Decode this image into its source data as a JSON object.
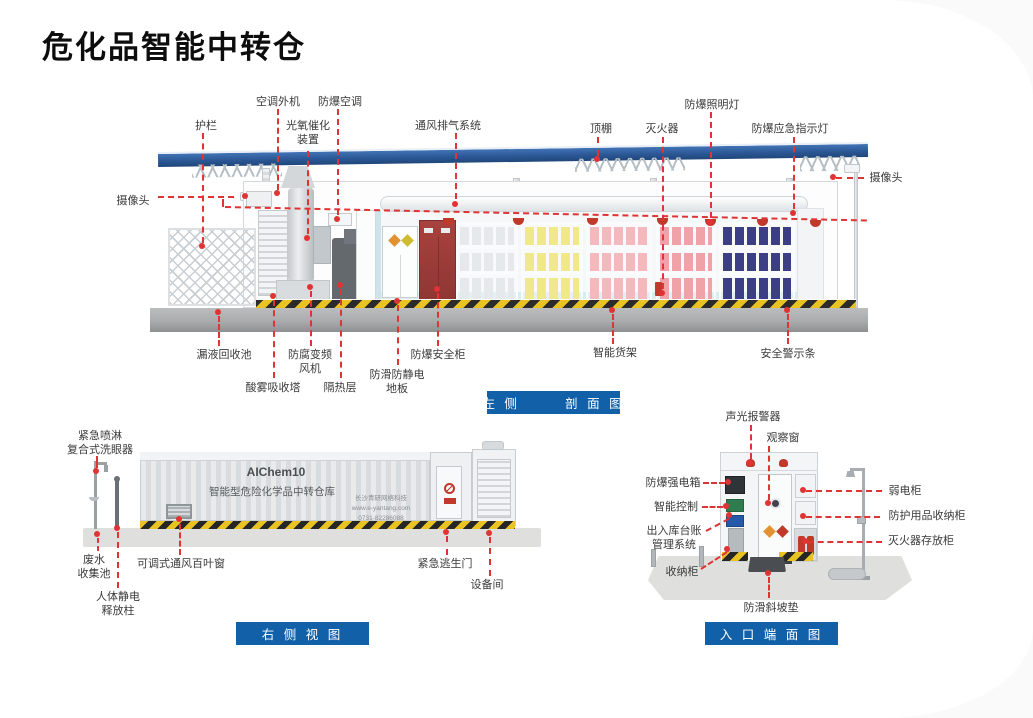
{
  "page": {
    "title": "危化品智能中转仓"
  },
  "colors": {
    "accent_blue": "#1160a8",
    "leader_red": "#e03333",
    "roof_blue": "#2d5f9e",
    "hazard_yellow": "#e9c322"
  },
  "cross_section": {
    "caption": "左 侧       剖 面 图",
    "labels": {
      "guardrail": "护栏",
      "camera_left": "摄像头",
      "ac_outdoor": "空调外机",
      "explosion_proof_ac": "防爆空调",
      "photocatalytic_device": "光氧催化\n装置",
      "ventilation_system": "通风排气系统",
      "canopy": "顶棚",
      "fire_extinguisher": "灭火器",
      "explosion_proof_lamp": "防爆照明灯",
      "emergency_indicator": "防爆应急指示灯",
      "camera_right": "摄像头",
      "leak_recovery_pool": "漏液回收池",
      "acid_mist_tower": "酸雾吸收塔",
      "anticorrosion_fan": "防腐变频\n风机",
      "insulation_layer": "隔热层",
      "antistatic_floor": "防滑防静电\n地板",
      "safety_cabinet": "防爆安全柜",
      "smart_shelf": "智能货架",
      "warning_strip": "安全警示条"
    }
  },
  "side_view": {
    "caption": "右 侧 视 图",
    "labels": {
      "eyewash": "紧急喷淋\n复合式洗眼器",
      "waste_pool": "废水\n收集池",
      "adjustable_louver": "可调式通风百叶窗",
      "static_release": "人体静电\n释放柱",
      "escape_door": "紧急逃生门",
      "equipment_room": "设备间"
    },
    "container": {
      "model": "AIChem10",
      "name": "智能型危险化学品中转仓库",
      "company": "长沙青研网络科技",
      "website": "www.e-yantang.com",
      "phone": "0731-82286088"
    }
  },
  "end_view": {
    "caption": "入 口 端 面 图",
    "labels": {
      "sound_light_alarm": "声光报警器",
      "observation_window": "观察窗",
      "strong_power_box": "防爆强电箱",
      "smart_control": "智能控制",
      "ledger_system": "出入库台账\n管理系统",
      "storage_cabinet": "收纳柜",
      "weak_power_cabinet": "弱电柜",
      "ppe_cabinet": "防护用品收纳柜",
      "extinguisher_cabinet": "灭火器存放柜",
      "antislip_ramp": "防滑斜坡垫"
    }
  }
}
